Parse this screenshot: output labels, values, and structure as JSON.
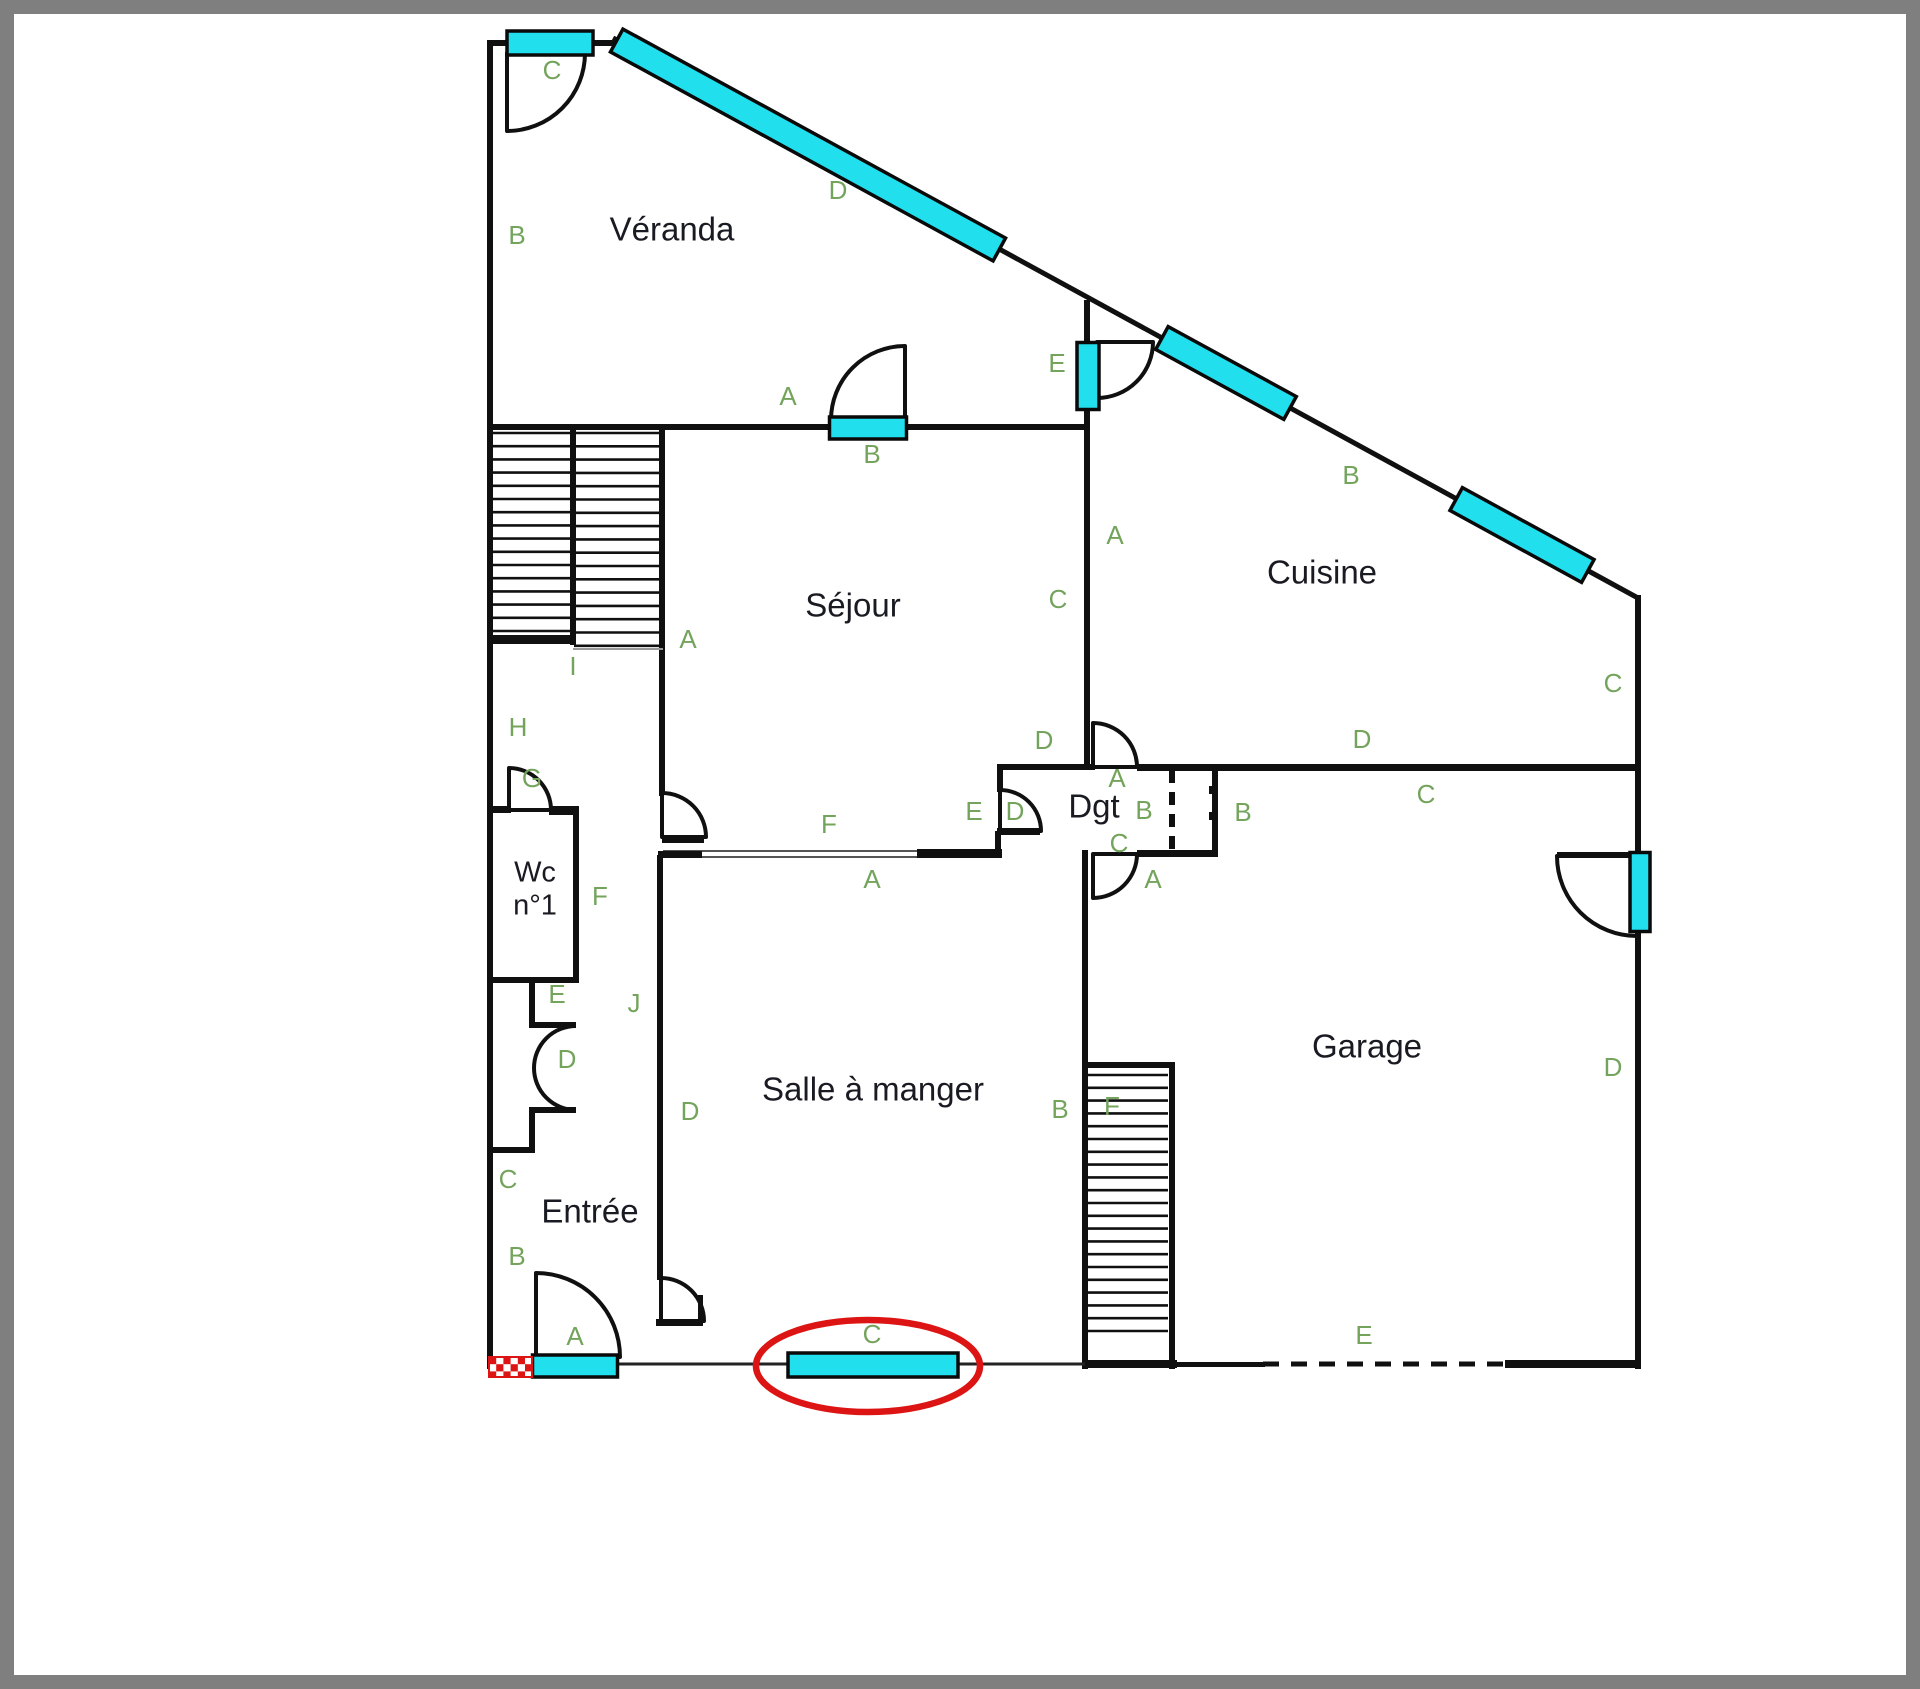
{
  "page": {
    "bg": "#ffffff",
    "frame_color": "#7f7f7f",
    "frame_width": 14
  },
  "plan": {
    "colors": {
      "wall": "#101010",
      "cyan": "#22dfee",
      "cyan_stroke": "#0a0a0a",
      "green": "#74a45c",
      "room_text": "#1a1a22",
      "red": "#dd1414",
      "thin": "#555555",
      "light": "#999999"
    },
    "rooms": [
      {
        "label": "Véranda",
        "x": 672,
        "y": 232,
        "size": 33
      },
      {
        "label": "Séjour",
        "x": 853,
        "y": 608,
        "size": 33
      },
      {
        "label": "Cuisine",
        "x": 1322,
        "y": 575,
        "size": 33
      },
      {
        "label": "Dgt",
        "x": 1094,
        "y": 809,
        "size": 33
      },
      {
        "label": "Wc",
        "x": 535,
        "y": 874,
        "size": 29
      },
      {
        "label": "n°1",
        "x": 535,
        "y": 907,
        "size": 29
      },
      {
        "label": "Salle à manger",
        "x": 873,
        "y": 1092,
        "size": 33
      },
      {
        "label": "Entrée",
        "x": 590,
        "y": 1214,
        "size": 33
      },
      {
        "label": "Garage",
        "x": 1367,
        "y": 1049,
        "size": 33
      }
    ],
    "letters": [
      {
        "t": "C",
        "x": 552,
        "y": 72
      },
      {
        "t": "B",
        "x": 517,
        "y": 237
      },
      {
        "t": "D",
        "x": 838,
        "y": 192
      },
      {
        "t": "A",
        "x": 788,
        "y": 398
      },
      {
        "t": "B",
        "x": 872,
        "y": 456
      },
      {
        "t": "E",
        "x": 1057,
        "y": 365
      },
      {
        "t": "A",
        "x": 1115,
        "y": 537
      },
      {
        "t": "C",
        "x": 1058,
        "y": 601
      },
      {
        "t": "B",
        "x": 1351,
        "y": 477
      },
      {
        "t": "C",
        "x": 1613,
        "y": 685
      },
      {
        "t": "D",
        "x": 1362,
        "y": 741
      },
      {
        "t": "C",
        "x": 1426,
        "y": 796
      },
      {
        "t": "D",
        "x": 1044,
        "y": 742
      },
      {
        "t": "A",
        "x": 688,
        "y": 641
      },
      {
        "t": "I",
        "x": 573,
        "y": 668
      },
      {
        "t": "H",
        "x": 518,
        "y": 729
      },
      {
        "t": "G",
        "x": 532,
        "y": 780
      },
      {
        "t": "F",
        "x": 600,
        "y": 898
      },
      {
        "t": "F",
        "x": 829,
        "y": 826
      },
      {
        "t": "A",
        "x": 872,
        "y": 881
      },
      {
        "t": "E",
        "x": 974,
        "y": 813
      },
      {
        "t": "D",
        "x": 1015,
        "y": 813
      },
      {
        "t": "A",
        "x": 1117,
        "y": 780
      },
      {
        "t": "B",
        "x": 1144,
        "y": 812
      },
      {
        "t": "C",
        "x": 1119,
        "y": 845
      },
      {
        "t": "A",
        "x": 1153,
        "y": 881
      },
      {
        "t": "B",
        "x": 1243,
        "y": 814
      },
      {
        "t": "E",
        "x": 557,
        "y": 996
      },
      {
        "t": "D",
        "x": 567,
        "y": 1061
      },
      {
        "t": "C",
        "x": 508,
        "y": 1181
      },
      {
        "t": "J",
        "x": 634,
        "y": 1005
      },
      {
        "t": "D",
        "x": 690,
        "y": 1113
      },
      {
        "t": "B",
        "x": 517,
        "y": 1258
      },
      {
        "t": "A",
        "x": 575,
        "y": 1338
      },
      {
        "t": "B",
        "x": 1060,
        "y": 1111
      },
      {
        "t": "F",
        "x": 1112,
        "y": 1108
      },
      {
        "t": "D",
        "x": 1613,
        "y": 1069
      },
      {
        "t": "E",
        "x": 1364,
        "y": 1337
      },
      {
        "t": "C",
        "x": 872,
        "y": 1336
      }
    ],
    "walls": [
      [
        487,
        40,
        131,
        6
      ],
      [
        487,
        40,
        6,
        1329
      ],
      [
        487,
        424,
        603,
        6
      ],
      [
        570,
        427,
        6,
        218
      ],
      [
        659,
        424,
        6,
        372
      ],
      [
        657,
        855,
        6,
        425
      ],
      [
        1084,
        300,
        6,
        470
      ],
      [
        487,
        806,
        24,
        7
      ],
      [
        549,
        806,
        30,
        9
      ],
      [
        573,
        810,
        6,
        173
      ],
      [
        487,
        977,
        91,
        6
      ],
      [
        917,
        849,
        85,
        9
      ],
      [
        997,
        764,
        6,
        28
      ],
      [
        997,
        764,
        98,
        6
      ],
      [
        1137,
        764,
        504,
        7
      ],
      [
        1212,
        768,
        6,
        87
      ],
      [
        1137,
        850,
        81,
        7
      ],
      [
        1082,
        850,
        6,
        519
      ],
      [
        1635,
        595,
        6,
        774
      ],
      [
        1085,
        1062,
        90,
        6
      ],
      [
        1169,
        1062,
        6,
        307
      ],
      [
        1082,
        1360,
        95,
        8
      ],
      [
        1505,
        1360,
        136,
        8
      ],
      [
        1175,
        1362,
        90,
        5
      ],
      [
        487,
        635,
        86,
        9
      ],
      [
        529,
        983,
        6,
        39
      ],
      [
        529,
        1022,
        47,
        6
      ],
      [
        529,
        1107,
        47,
        6
      ],
      [
        529,
        1113,
        6,
        35
      ],
      [
        487,
        1147,
        48,
        6
      ],
      [
        1209,
        786,
        7,
        8
      ],
      [
        1209,
        812,
        7,
        8
      ]
    ],
    "diagonal": {
      "x1": 613,
      "y1": 38,
      "x2": 1638,
      "y2": 598,
      "w": 5
    },
    "thin_lines": [
      [
        663,
        851,
        917,
        851,
        2,
        "#555555"
      ],
      [
        663,
        857,
        917,
        857,
        2,
        "#555555"
      ],
      [
        573,
        649,
        663,
        649,
        2,
        "#999999"
      ],
      [
        533,
        1364,
        1085,
        1364,
        3,
        "#222222"
      ]
    ],
    "dashed_lines": [
      {
        "x1": 1172,
        "y1": 770,
        "x2": 1172,
        "y2": 853,
        "w": 6,
        "dash": "13 9"
      },
      {
        "x1": 1263,
        "y1": 1364,
        "x2": 1505,
        "y2": 1364,
        "w": 5,
        "dash": "16 12"
      }
    ],
    "doors": [
      {
        "name": "door-c-veranda",
        "cx": 507,
        "cy": 53,
        "r": 78,
        "a1": 0,
        "a2": 90
      },
      {
        "name": "door-b-sejour",
        "cx": 905,
        "cy": 420,
        "r": 74,
        "a1": 180,
        "a2": 270
      },
      {
        "name": "door-e-veranda-cuisine",
        "cx": 1097,
        "cy": 342,
        "r": 56,
        "a1": 0,
        "a2": 90
      },
      {
        "name": "door-sejour-couloir",
        "cx": 662,
        "cy": 837,
        "r": 44,
        "a1": 270,
        "a2": 360
      },
      {
        "name": "door-wc",
        "cx": 509,
        "cy": 810,
        "r": 42,
        "a1": 270,
        "a2": 360
      },
      {
        "name": "door-dgt-sejour",
        "cx": 1000,
        "cy": 831,
        "r": 41,
        "a1": 270,
        "a2": 360
      },
      {
        "name": "door-dgt-cuisine",
        "cx": 1093,
        "cy": 767,
        "r": 44,
        "a1": 270,
        "a2": 360
      },
      {
        "name": "door-dgt-salle",
        "cx": 1093,
        "cy": 854,
        "r": 44,
        "a1": 0,
        "a2": 90
      },
      {
        "name": "door-garage",
        "cx": 1637,
        "cy": 856,
        "r": 80,
        "a1": 90,
        "a2": 180
      },
      {
        "name": "door-a-entree",
        "cx": 536,
        "cy": 1357,
        "r": 84,
        "a1": 270,
        "a2": 360
      },
      {
        "name": "door-entree-salle",
        "cx": 661,
        "cy": 1321,
        "r": 43,
        "a1": 270,
        "a2": 360
      }
    ],
    "arcs": [
      {
        "x1": 576,
        "y1": 1026,
        "x2": 576,
        "y2": 1110,
        "r": 42,
        "sweep": 0
      }
    ],
    "stubs": [
      [
        662,
        836,
        42,
        7
      ],
      [
        658,
        851,
        44,
        7
      ],
      [
        997,
        828,
        43,
        7
      ],
      [
        995,
        831,
        6,
        25
      ],
      [
        698,
        1295,
        5,
        28
      ],
      [
        656,
        1319,
        47,
        7
      ],
      [
        1557,
        852,
        83,
        6
      ]
    ],
    "windows": [
      {
        "name": "window-c-top",
        "cx": 550,
        "cy": 43,
        "w": 86,
        "h": 24,
        "rot": 0
      },
      {
        "name": "window-b-sejour",
        "cx": 868,
        "cy": 428,
        "w": 77,
        "h": 22,
        "rot": 0
      },
      {
        "name": "window-e-cuisine",
        "cx": 1088,
        "cy": 376,
        "w": 22,
        "h": 67,
        "rot": 0
      },
      {
        "name": "window-d-veranda",
        "cx": 808,
        "cy": 145,
        "w": 436,
        "h": 26,
        "rot": 28.65
      },
      {
        "name": "window-b-cuisine-1",
        "cx": 1226,
        "cy": 373,
        "w": 146,
        "h": 26,
        "rot": 28.65
      },
      {
        "name": "window-b-cuisine-2",
        "cx": 1522,
        "cy": 535,
        "w": 150,
        "h": 26,
        "rot": 28.65
      },
      {
        "name": "window-garage-door",
        "cx": 1640,
        "cy": 892,
        "w": 20,
        "h": 79,
        "rot": 0
      },
      {
        "name": "window-a-entree",
        "cx": 575,
        "cy": 1366,
        "w": 85,
        "h": 22,
        "rot": 0
      },
      {
        "name": "window-c-salle",
        "cx": 873,
        "cy": 1365,
        "w": 170,
        "h": 24,
        "rot": 0
      }
    ],
    "stairs": [
      {
        "name": "stairs-main-left",
        "x1": 489,
        "x2": 572,
        "y0": 433,
        "step": 13.2,
        "n": 16
      },
      {
        "name": "stairs-main-right",
        "x1": 574,
        "x2": 662,
        "y0": 433,
        "step": 13.3,
        "n": 17
      },
      {
        "name": "stairs-garage",
        "x1": 1087,
        "x2": 1168,
        "y0": 1075,
        "step": 12.8,
        "n": 21
      }
    ],
    "checker": {
      "x": 489,
      "y": 1357,
      "w": 43,
      "h": 20,
      "cell": 7.2
    },
    "highlight_ellipse": {
      "cx": 868,
      "cy": 1366,
      "rx": 112,
      "ry": 46,
      "sw": 6.5
    }
  }
}
